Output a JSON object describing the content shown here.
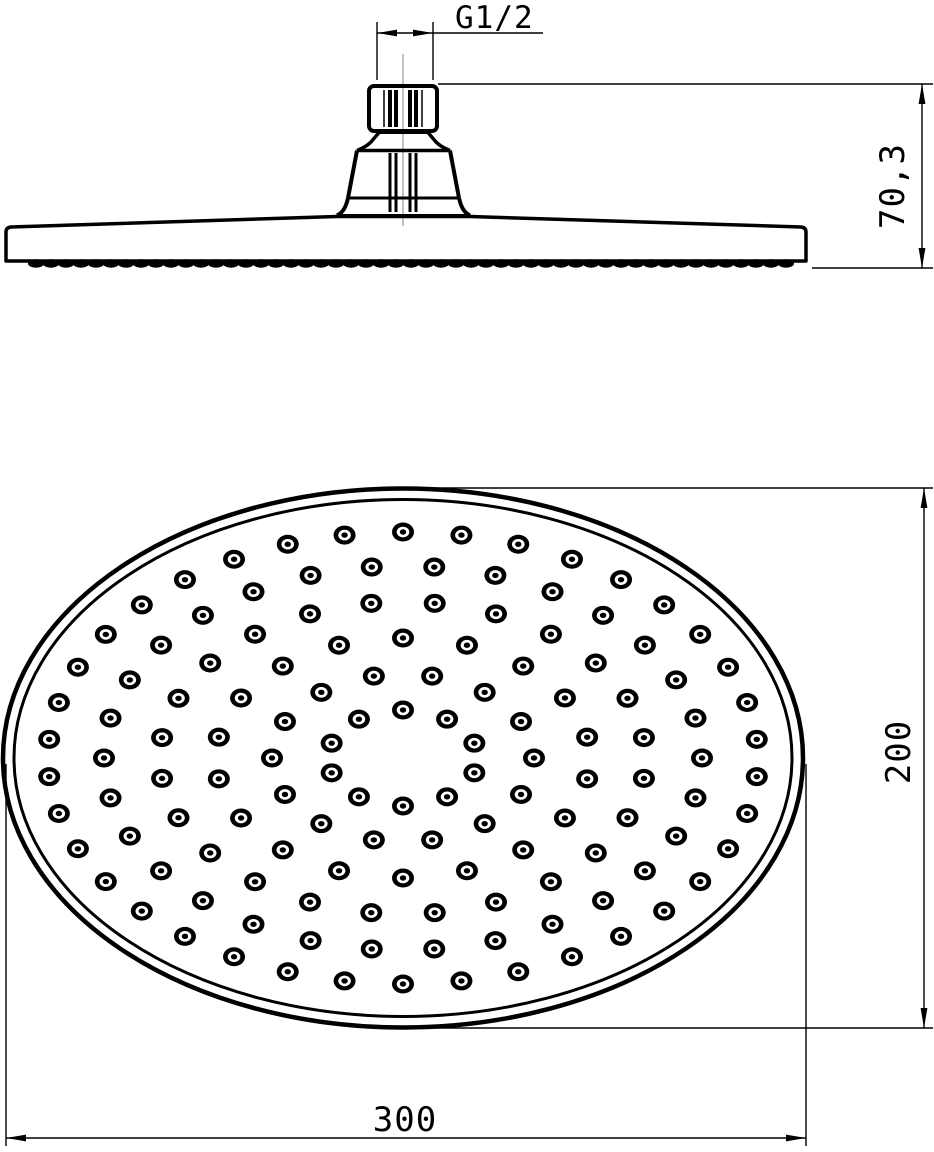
{
  "drawing_title": "shower-head-technical-drawing",
  "labels": {
    "thread": "G1/2",
    "head_height": "70,3",
    "face_height": "200",
    "face_width": "300"
  },
  "colors": {
    "ink": "#000000",
    "bg": "#ffffff",
    "centerline": "#9a9a9a"
  },
  "geometry": {
    "side_view": {
      "centerline": [
        403,
        54,
        403,
        226
      ],
      "nut": {
        "x": 369,
        "y": 86,
        "w": 68,
        "h": 45,
        "r": 5,
        "sw": 4
      },
      "nut_knurl": {
        "y1": 90,
        "y2": 127,
        "lines": [
          [
            -19,
            1.5
          ],
          [
            -13,
            4
          ],
          [
            -7,
            4
          ],
          [
            7,
            4
          ],
          [
            13,
            4
          ],
          [
            19,
            1.5
          ]
        ]
      },
      "cone_knurl": {
        "y1": 153,
        "y2": 212,
        "lines": [
          [
            -13,
            3
          ],
          [
            -7,
            3
          ],
          [
            7,
            3
          ],
          [
            13,
            3
          ]
        ]
      },
      "paths": [
        {
          "d": "M379,132.5 L428,132.5",
          "w": 3
        },
        {
          "d": "M379,132.5 L371,142 Q366,147 357,150.5",
          "w": 3.5
        },
        {
          "d": "M428,132.5 L436,142 Q441,147 450,150.5",
          "w": 3.5
        },
        {
          "d": "M357,150.5 L450,150.5",
          "w": 3.5
        },
        {
          "d": "M357,150.5 L348,198",
          "w": 4
        },
        {
          "d": "M450,150.5 L459,198",
          "w": 4
        },
        {
          "d": "M348,198 L459,198",
          "w": 3
        },
        {
          "d": "M348,198 C346,207 343,212.5 337,215.5",
          "w": 4
        },
        {
          "d": "M459,198 C461,207 464,212.5 470,215.5",
          "w": 4
        },
        {
          "d": "M337,215.5 L470,215.5",
          "w": 3
        },
        {
          "d": "M6,261 L6,232 Q6,227.5 11,227 L337,216.5 L470,216.5 L801,227 Q806,227.5 806,232 L806,261 Z",
          "w": 3.5
        }
      ],
      "bumps": {
        "x1": 36,
        "x2": 786,
        "step": 15,
        "cy": 263.5,
        "rx": 8,
        "ry": 4.2
      }
    },
    "face_view": {
      "cx": 403,
      "cy": 758,
      "rims": [
        {
          "rx": 400,
          "ry": 269.5,
          "w": 4.5
        },
        {
          "rx": 389,
          "ry": 258.5,
          "w": 3
        }
      ],
      "nozzle": {
        "rx": 11,
        "ry": 9.5,
        "mid_rx": 6.3,
        "mid_ry": 5.3,
        "dot_rx": 3.2,
        "dot_ry": 2.7
      },
      "rings": [
        {
          "rx": 75,
          "ry": 48,
          "count": 10,
          "stagger": false
        },
        {
          "rx": 131,
          "ry": 84,
          "count": 14,
          "stagger": true
        },
        {
          "rx": 187,
          "ry": 120,
          "count": 18,
          "stagger": false
        },
        {
          "rx": 243,
          "ry": 156,
          "count": 24,
          "stagger": true
        },
        {
          "rx": 299,
          "ry": 192,
          "count": 30,
          "stagger": true
        },
        {
          "rx": 355,
          "ry": 226,
          "count": 38,
          "stagger": false
        }
      ]
    },
    "dims": [
      {
        "key": "thread",
        "ext": [
          [
            377,
            22,
            377,
            80
          ],
          [
            433,
            22,
            433,
            80
          ]
        ],
        "line": [
          377,
          33,
          543,
          33
        ],
        "arrows": [
          [
            377,
            33,
            180
          ],
          [
            433,
            33,
            0
          ]
        ]
      },
      {
        "key": "head_height",
        "ext": [
          [
            438,
            84,
            933,
            84
          ],
          [
            812,
            268,
            933,
            268
          ]
        ],
        "line": [
          922,
          84,
          922,
          268
        ],
        "arrows": [
          [
            922,
            84,
            -90
          ],
          [
            922,
            268,
            90
          ]
        ]
      },
      {
        "key": "face_height",
        "ext": [
          [
            408,
            488,
            933,
            488
          ],
          [
            425,
            1028,
            933,
            1028
          ]
        ],
        "line": [
          924,
          488,
          924,
          1028
        ],
        "arrows": [
          [
            924,
            488,
            -90
          ],
          [
            924,
            1028,
            90
          ]
        ]
      },
      {
        "key": "face_width",
        "ext": [
          [
            6,
            764,
            6,
            1146
          ],
          [
            806,
            764,
            806,
            1146
          ]
        ],
        "line": [
          6,
          1138,
          806,
          1138
        ],
        "arrows": [
          [
            6,
            1138,
            180
          ],
          [
            806,
            1138,
            0
          ]
        ]
      }
    ],
    "arrow": {
      "len": 20,
      "half_w": 3.4
    }
  }
}
